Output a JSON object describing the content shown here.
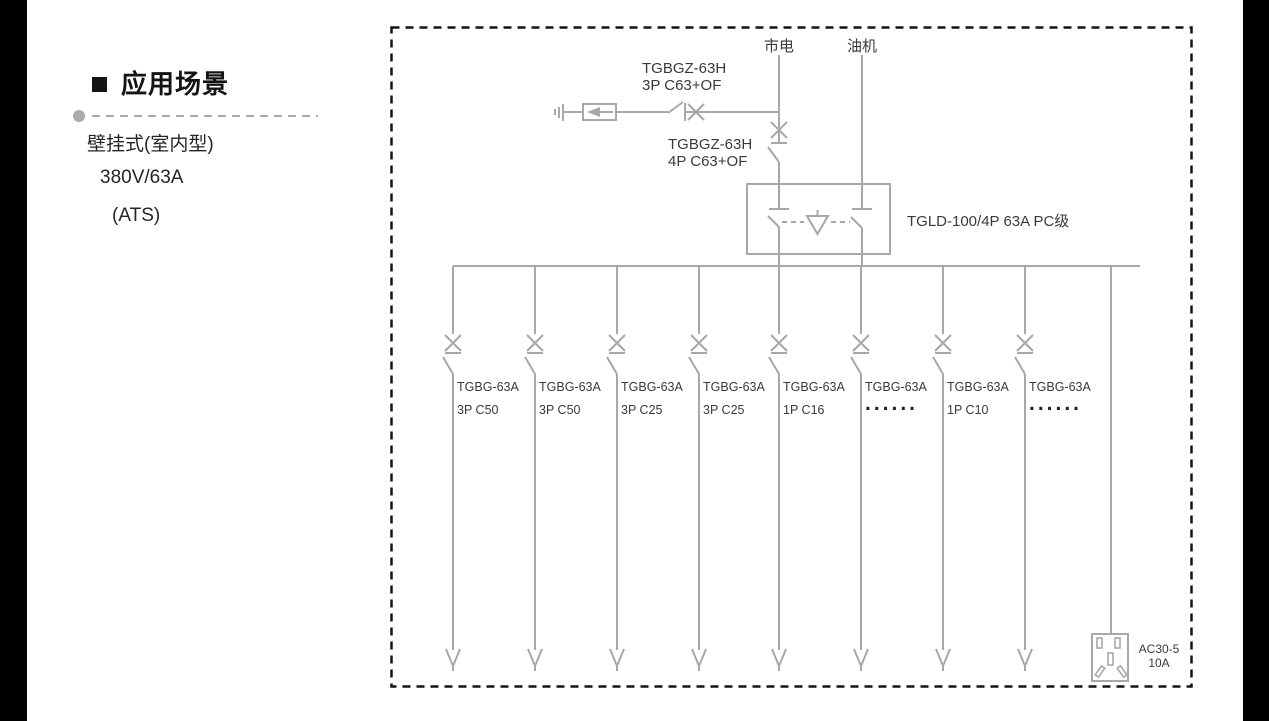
{
  "page": {
    "background": "#ffffff",
    "side_band_color": "#000000",
    "line_color": "#a8a8a8",
    "text_color": "#3a3a3a",
    "border_color": "#141414"
  },
  "sidebar": {
    "heading": "应用场景",
    "lines": [
      "壁挂式(室内型)",
      "380V/63A",
      "(ATS)"
    ]
  },
  "diagram": {
    "sources": [
      {
        "label": "市电"
      },
      {
        "label": "油机"
      }
    ],
    "spd_branch_breaker": {
      "model": "TGBGZ-63H",
      "spec": "3P C63+OF"
    },
    "incoming_breaker": {
      "model": "TGBGZ-63H",
      "spec": "4P C63+OF"
    },
    "ats": {
      "label": "TGLD-100/4P 63A PC级"
    },
    "branches": [
      {
        "model": "TGBG-63A",
        "spec": "3P C50"
      },
      {
        "model": "TGBG-63A",
        "spec": "3P C50"
      },
      {
        "model": "TGBG-63A",
        "spec": "3P C25"
      },
      {
        "model": "TGBG-63A",
        "spec": "3P C25"
      },
      {
        "model": "TGBG-63A",
        "spec": "1P C16"
      },
      {
        "model": "TGBG-63A",
        "spec": "......"
      },
      {
        "model": "TGBG-63A",
        "spec": "1P C10"
      },
      {
        "model": "TGBG-63A",
        "spec": "......"
      }
    ],
    "socket": {
      "model": "AC30-5",
      "rating": "10A"
    }
  }
}
